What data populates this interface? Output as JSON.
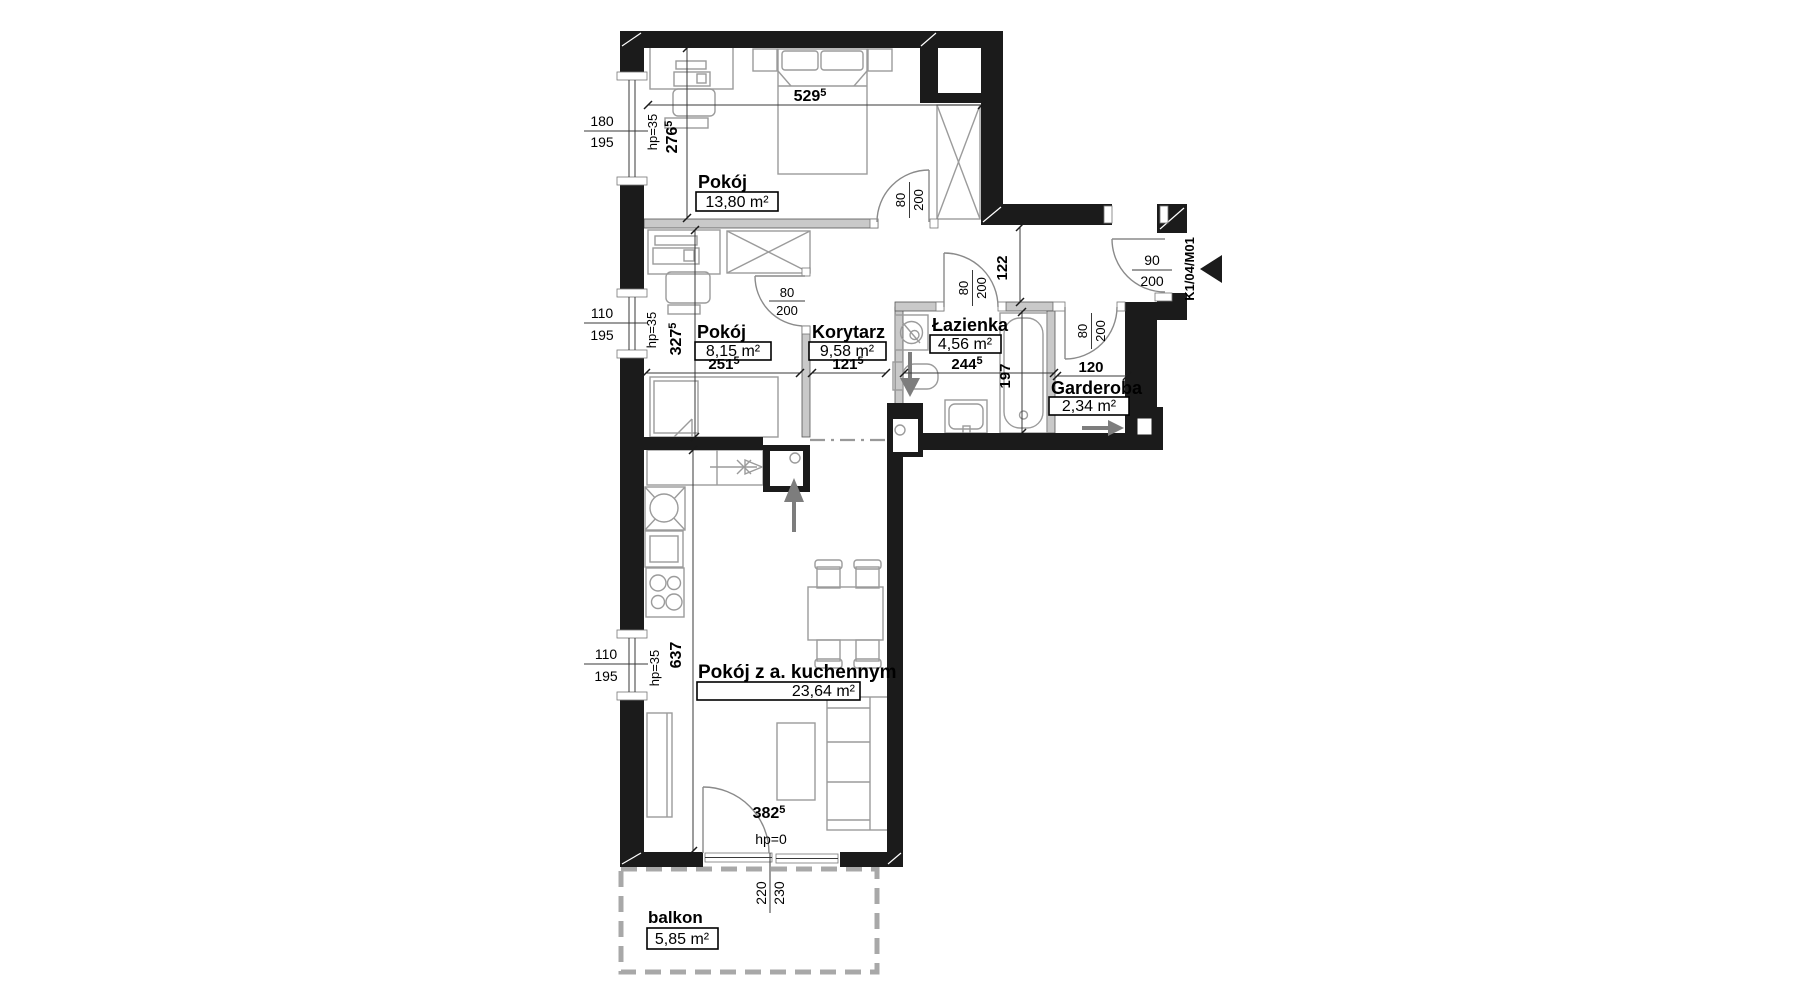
{
  "plan": {
    "rooms": {
      "pokoj1": {
        "name": "Pokój",
        "area": "13,80 m²"
      },
      "pokoj2": {
        "name": "Pokój",
        "area": "8,15 m²"
      },
      "korytarz": {
        "name": "Korytarz",
        "area": "9,58 m²"
      },
      "lazienka": {
        "name": "Łazienka",
        "area": "4,56 m²"
      },
      "garderoba": {
        "name": "Garderoba",
        "area": "2,34 m²"
      },
      "salon": {
        "name": "Pokój z a. kuchennym",
        "area": "23,64 m²"
      },
      "balkon": {
        "name": "balkon",
        "area": "5,85 m²"
      }
    },
    "dims": {
      "d5295": {
        "v": "529",
        "sup": "5"
      },
      "d2765": {
        "v": "276",
        "sup": "5"
      },
      "d3275": {
        "v": "327",
        "sup": "5"
      },
      "d2515": {
        "v": "251",
        "sup": "5"
      },
      "d1215": {
        "v": "121",
        "sup": "5"
      },
      "d2445": {
        "v": "244",
        "sup": "5"
      },
      "d3825": {
        "v": "382",
        "sup": "5"
      },
      "d197": "197",
      "d122": "122",
      "d120": "120",
      "d637": "637",
      "d220": "220",
      "d230": "230"
    },
    "windows": {
      "w1": {
        "w": "180",
        "h": "195",
        "hp": "hp=35"
      },
      "w2": {
        "w": "110",
        "h": "195",
        "hp": "hp=35"
      },
      "w3": {
        "w": "110",
        "h": "195",
        "hp": "hp=35"
      }
    },
    "balcony_door": {
      "hp": "hp=0"
    },
    "doors": {
      "entrance": {
        "w": "90",
        "h": "200",
        "code": "K1/04/M01"
      },
      "d1": {
        "w": "80",
        "h": "200"
      },
      "d2": {
        "w": "80",
        "h": "200"
      },
      "d3": {
        "w": "80",
        "h": "200"
      },
      "d4": {
        "w": "80",
        "h": "200"
      }
    }
  }
}
